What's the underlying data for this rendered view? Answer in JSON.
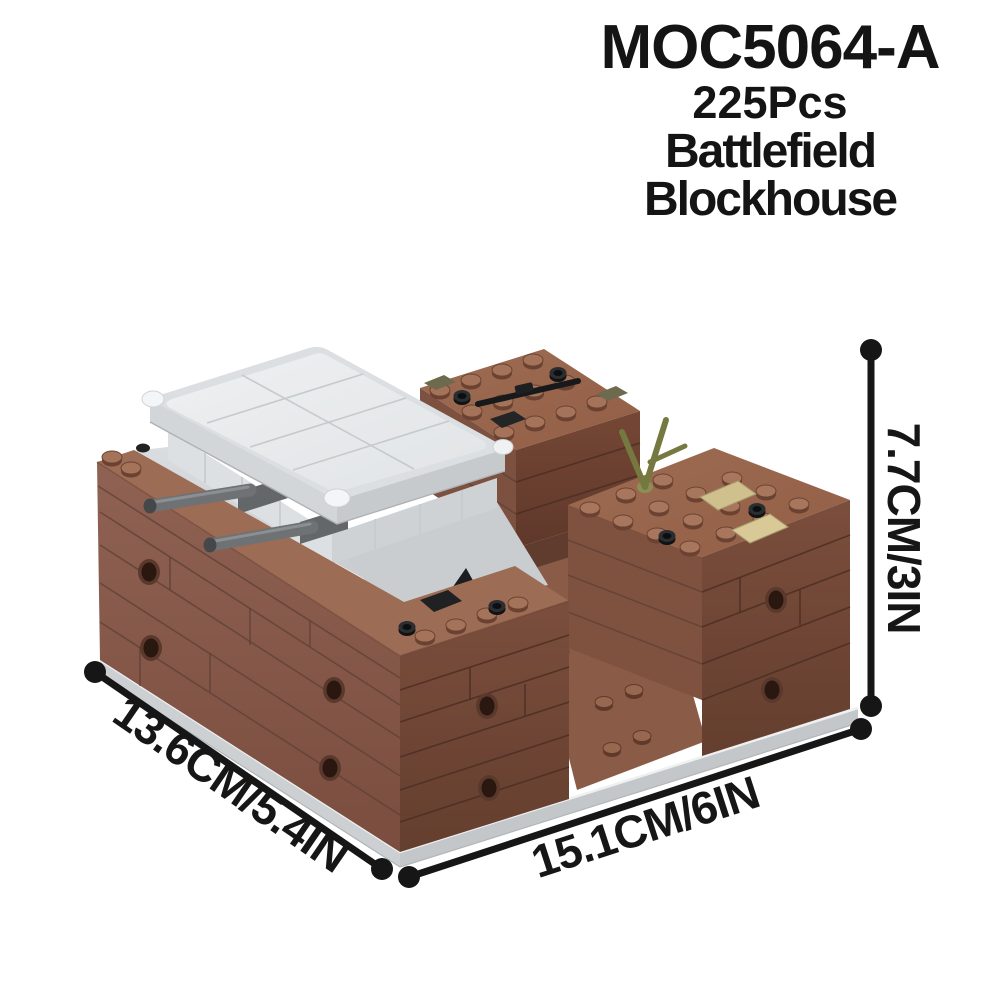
{
  "product": {
    "model_code": "MOC5064-A",
    "piece_count": "225Pcs",
    "name_line_1": "Battlefield",
    "name_line_2": "Blockhouse"
  },
  "dimensions": {
    "depth_label": "13.6CM/5.4IN",
    "width_label": "15.1CM/6IN",
    "height_label": "7.7CM/3IN"
  },
  "palette": {
    "background": "#ffffff",
    "text": "#141414",
    "dimension_line": "#161616",
    "brick_brown_light": "#9c6c55",
    "brick_brown": "#8a5c4a",
    "brick_brown_dark": "#6d4435",
    "trench_brown": "#8a5b46",
    "bunker_gray_light": "#ebedee",
    "bunker_gray": "#d3d6d8",
    "baseplate_gray": "#ccd0d2",
    "accessory_black": "#1d1f21",
    "accessory_olive": "#75783f",
    "accessory_tan": "#cfc08e",
    "barrel_gray": "#6e7274"
  }
}
